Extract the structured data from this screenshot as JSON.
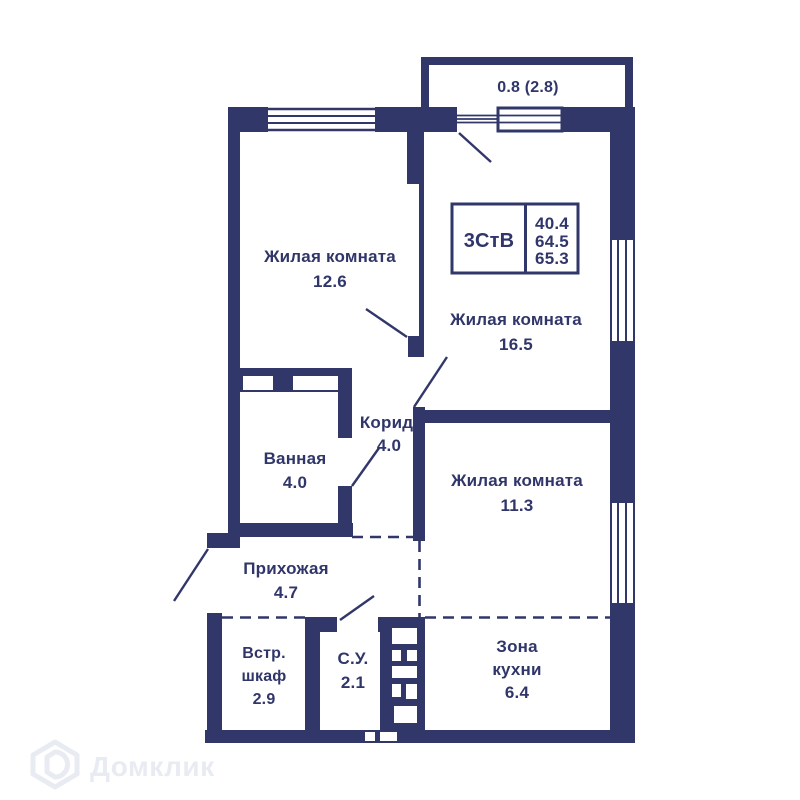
{
  "watermark": {
    "brand": "Домклик"
  },
  "plan": {
    "balcony": {
      "label": "0.8 (2.8)"
    },
    "info_box": {
      "layout_type": "3СтВ",
      "values": {
        "v1": "40.4",
        "v2": "64.5",
        "v3": "65.3"
      }
    },
    "rooms": {
      "living1": {
        "name": "Жилая комната",
        "area": "12.6"
      },
      "living2": {
        "name": "Жилая комната",
        "area": "16.5"
      },
      "living3": {
        "name": "Жилая комната",
        "area": "11.3"
      },
      "bathroom": {
        "name": "Ванная",
        "area": "4.0"
      },
      "corridor": {
        "name": "Корид.",
        "area": "4.0"
      },
      "hallway": {
        "name": "Прихожая",
        "area": "4.7"
      },
      "closet": {
        "name_line1": "Встр.",
        "name_line2": "шкаф",
        "area": "2.9"
      },
      "wc": {
        "name": "С.У.",
        "area": "2.1"
      },
      "kitchen": {
        "name_line1": "Зона",
        "name_line2": "кухни",
        "area": "6.4"
      }
    },
    "colors": {
      "wall": "#32376a",
      "text": "#303669",
      "watermark": "#e9ebf3",
      "background": "#ffffff"
    }
  }
}
